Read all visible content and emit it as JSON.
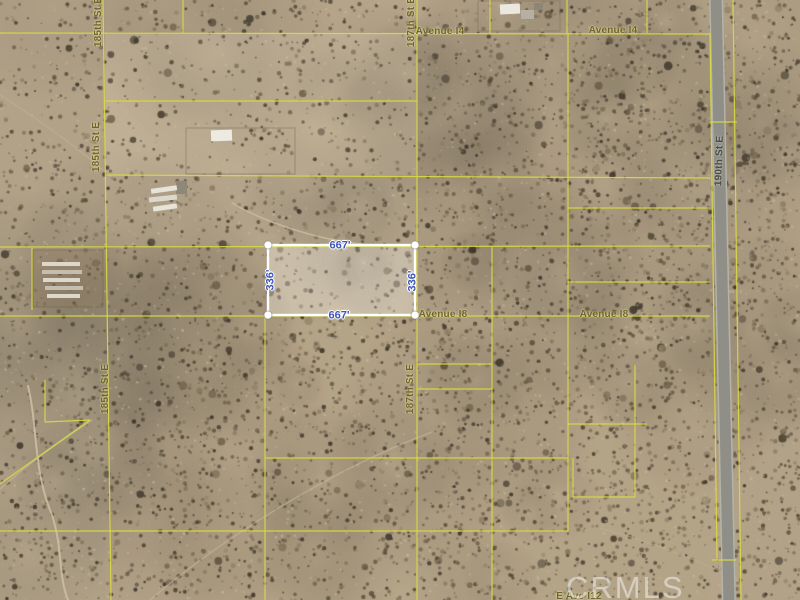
{
  "map": {
    "watermark": "CRMLS",
    "parcel": {
      "x": 268,
      "y": 245,
      "w": 147,
      "h": 70,
      "border_color": "#ffffff",
      "fill": "rgba(255,252,243,0.22)",
      "dot_radius": 4
    },
    "dimension_labels": [
      {
        "name": "667-top",
        "text": "667'",
        "x": 340,
        "y": 246,
        "rot": 0
      },
      {
        "name": "667-bottom",
        "text": "667'",
        "x": 339,
        "y": 316,
        "rot": 0
      },
      {
        "name": "336-left",
        "text": "336'",
        "x": 271,
        "y": 280,
        "rot": -90
      },
      {
        "name": "336-right",
        "text": "336'",
        "x": 413,
        "y": 281,
        "rot": -90
      }
    ],
    "street_labels": [
      {
        "name": "avenue-i4-west",
        "text": "Avenue I4",
        "x": 440,
        "y": 32,
        "rot": 0,
        "kind": "street"
      },
      {
        "name": "avenue-i4-east",
        "text": "Avenue I4",
        "x": 613,
        "y": 31,
        "rot": 0,
        "kind": "street"
      },
      {
        "name": "avenue-i8-west",
        "text": "Avenue I8",
        "x": 443,
        "y": 315,
        "rot": 0,
        "kind": "street"
      },
      {
        "name": "avenue-i8-east",
        "text": "Avenue I8",
        "x": 604,
        "y": 315,
        "rot": 0,
        "kind": "street"
      },
      {
        "name": "185th-st-e-top",
        "text": "185th St E",
        "x": 99,
        "y": 22,
        "rot": -90,
        "kind": "street"
      },
      {
        "name": "185th-st-e-mid",
        "text": "185th St E",
        "x": 97,
        "y": 147,
        "rot": -90,
        "kind": "street"
      },
      {
        "name": "185th-st-e-low",
        "text": "185th St E",
        "x": 106,
        "y": 389,
        "rot": -90,
        "kind": "street"
      },
      {
        "name": "187th-st-e-top",
        "text": "187th St E",
        "x": 412,
        "y": 22,
        "rot": -90,
        "kind": "street"
      },
      {
        "name": "187th-st-e-mid",
        "text": "187th St E",
        "x": 411,
        "y": 389,
        "rot": -90,
        "kind": "street"
      },
      {
        "name": "190th-st-e",
        "text": "190th St E",
        "x": 720,
        "y": 161,
        "rot": -88,
        "kind": "road"
      },
      {
        "name": "e-ave-i12",
        "text": "E Ave I12",
        "x": 579,
        "y": 597,
        "rot": 0,
        "kind": "street"
      }
    ],
    "colors": {
      "boundary_yellow": "#d9d944",
      "sand_base": "#b5a489",
      "road_gray": "#8f8f88",
      "road_shoulder": "#b3b3aa",
      "street_label": "#6e6527",
      "dimension_blue": "#3c55b8",
      "watermark_gray": "#f1f1ee"
    },
    "road": {
      "x_top": 716,
      "x_bottom": 729,
      "width": 11
    },
    "boundary_lines": [
      [
        103,
        0,
        111,
        600
      ],
      [
        183,
        0,
        183,
        33
      ],
      [
        417,
        0,
        417,
        600
      ],
      [
        490,
        0,
        490,
        33
      ],
      [
        567,
        0,
        567,
        33
      ],
      [
        647,
        0,
        647,
        33
      ],
      [
        265,
        316,
        265,
        600
      ],
      [
        492,
        247,
        492,
        600
      ],
      [
        568,
        33,
        568,
        531
      ],
      [
        710,
        33,
        717,
        560
      ],
      [
        733,
        0,
        741,
        600
      ],
      [
        32,
        248,
        32,
        310
      ],
      [
        45,
        380,
        45,
        422
      ],
      [
        635,
        364,
        635,
        497
      ],
      [
        573,
        458,
        573,
        497
      ],
      [
        0,
        33,
        710,
        34
      ],
      [
        105,
        101,
        417,
        101
      ],
      [
        105,
        175,
        710,
        178
      ],
      [
        568,
        208,
        710,
        208
      ],
      [
        0,
        247,
        710,
        246
      ],
      [
        568,
        282,
        710,
        282
      ],
      [
        0,
        316,
        710,
        316
      ],
      [
        417,
        364,
        492,
        364
      ],
      [
        417,
        389,
        492,
        389
      ],
      [
        568,
        424,
        647,
        424
      ],
      [
        265,
        458,
        568,
        458
      ],
      [
        573,
        497,
        635,
        497
      ],
      [
        0,
        531,
        568,
        531
      ],
      [
        710,
        122,
        737,
        122
      ],
      [
        45,
        422,
        90,
        420
      ],
      [
        90,
        420,
        0,
        484
      ],
      [
        712,
        560,
        736,
        560
      ]
    ],
    "structures": [
      {
        "name": "homestead-roof",
        "x": 500,
        "y": 4,
        "w": 20,
        "h": 10,
        "fill": "#ebe8df",
        "rot": -3
      },
      {
        "name": "homestead-bldg",
        "x": 521,
        "y": 10,
        "w": 13,
        "h": 9,
        "fill": "#b7b0a2",
        "rot": 0
      },
      {
        "name": "homestead-shed",
        "x": 534,
        "y": 3,
        "w": 9,
        "h": 7,
        "fill": "#8d8576",
        "rot": 0
      },
      {
        "name": "farm-building",
        "x": 211,
        "y": 130,
        "w": 21,
        "h": 11,
        "fill": "#eceae1",
        "rot": -2
      },
      {
        "name": "farm-shed",
        "x": 176,
        "y": 181,
        "w": 11,
        "h": 13,
        "fill": "#8f8777",
        "rot": 0
      },
      {
        "name": "trailer-1",
        "x": 151,
        "y": 187,
        "w": 26,
        "h": 5,
        "fill": "#e6e3da",
        "rot": -8
      },
      {
        "name": "trailer-2",
        "x": 149,
        "y": 196,
        "w": 28,
        "h": 5,
        "fill": "#dcd8cd",
        "rot": -6
      },
      {
        "name": "trailer-3",
        "x": 153,
        "y": 205,
        "w": 24,
        "h": 5,
        "fill": "#e6e3da",
        "rot": -8
      }
    ],
    "corral": {
      "x": 33,
      "y": 250,
      "w": 70,
      "h": 57,
      "pens": [
        [
          42,
          262,
          38,
          4
        ],
        [
          42,
          270,
          40,
          4
        ],
        [
          43,
          278,
          37,
          4
        ],
        [
          45,
          286,
          38,
          4
        ],
        [
          47,
          294,
          33,
          4
        ]
      ]
    },
    "fences": [
      [
        186,
        128,
        109,
        46
      ],
      [
        478,
        1,
        82,
        30
      ]
    ],
    "dirt_paths": [
      {
        "d": "M 28 386 C 38 428 33 470 52 515 C 63 549 58 575 68 600",
        "w": 2,
        "c": "rgba(206,192,164,0.85)"
      },
      {
        "d": "M 0 489 C 30 462 62 440 92 420",
        "w": 1.5,
        "c": "rgba(199,186,158,0.6)"
      },
      {
        "d": "M 232 203 C 268 224 320 240 362 244",
        "w": 1.5,
        "c": "rgba(203,189,160,0.8)"
      },
      {
        "d": "M 150 600 C 220 540 330 470 432 432",
        "w": 1.5,
        "c": "rgba(200,187,158,0.5)"
      },
      {
        "d": "M 600 528 C 644 540 700 560 742 582",
        "w": 1.5,
        "c": "rgba(190,178,152,0.5)"
      },
      {
        "d": "M 0 95 C 40 120 80 150 103 170",
        "w": 1.2,
        "c": "rgba(196,183,156,0.5)"
      }
    ]
  }
}
